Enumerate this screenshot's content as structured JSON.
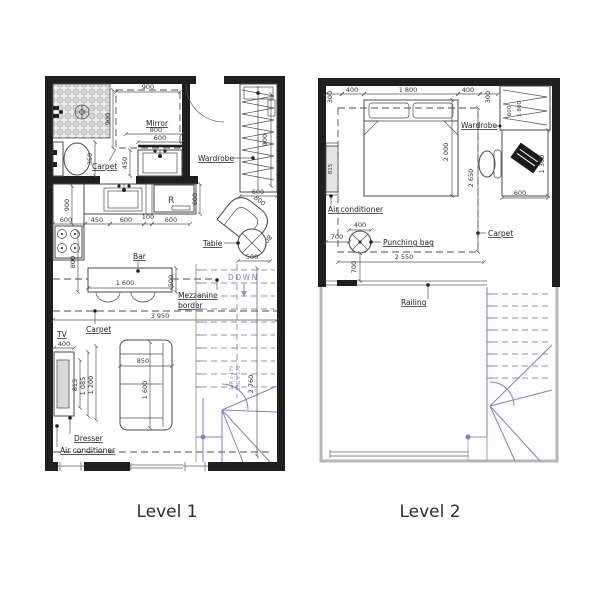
{
  "page": {
    "background": "#ffffff"
  },
  "colors": {
    "wall": "#1f1f1f",
    "line": "#454545",
    "dimension": "#555555",
    "stairs_blue": "#7b7ed2",
    "void_border": "#b8b8b8"
  },
  "level1": {
    "name": "Level 1",
    "labels": {
      "mirror": "Mirror",
      "carpet_bath": "Carpet",
      "wardrobe": "Wardrobe",
      "fridge": "R",
      "table": "Table",
      "bar": "Bar",
      "mezzanine_1": "Mezzanine",
      "mezzanine_2": "border",
      "carpet_living": "Carpet",
      "tv": "TV",
      "dresser": "Dresser",
      "air_conditioner": "Air conditioner",
      "down": "DOWN"
    },
    "dims": {
      "bath_carpet_w": "900",
      "bath_carpet_h": "900",
      "mirror_w": "800",
      "vanity_w": "600",
      "vanity_d": "450",
      "toilet": "350",
      "kitchen_len": "900",
      "k_600_left": "600",
      "k_450": "450",
      "k_600_mid": "600",
      "k_100": "100",
      "k_600_right": "600",
      "fridge_d": "600",
      "wardrobe_len": "900",
      "wardrobe_w": "600",
      "chair_w": "800",
      "chair_d": "800",
      "table_d": "500",
      "bar_offset": "800",
      "bar_len": "1 600",
      "bar_d": "500",
      "room_w": "3 950",
      "tv_w": "400",
      "tv_d": "815",
      "dresser_l": "1 085",
      "dresser_l2": "1 200",
      "sofa_w": "850",
      "sofa_len": "1 600",
      "stair_height": "2 760",
      "stair_note_1": "14R x 179",
      "stair_note_2": "13G x 270"
    }
  },
  "level2": {
    "name": "Level 2",
    "labels": {
      "wardrobe": "Wardrobe",
      "air_conditioner": "Air conditioner",
      "carpet": "Carpet",
      "punching_bag": "Punching bag",
      "railing": "Railing"
    },
    "dims": {
      "wall_off_left": "300",
      "bed_off_left": "400",
      "bed_w": "1 800",
      "bed_off_right": "400",
      "wall_off_right": "300",
      "bed_len": "2 000",
      "ac_len": "815",
      "carpet_len": "2 650",
      "carpet_w": "2 550",
      "wardrobe_d": "600",
      "wardrobe_len": "1 800",
      "desk_w": "600",
      "desk_len": "1 300",
      "bag_d": "400",
      "bag_off_h": "700",
      "bag_off_v": "700"
    }
  }
}
